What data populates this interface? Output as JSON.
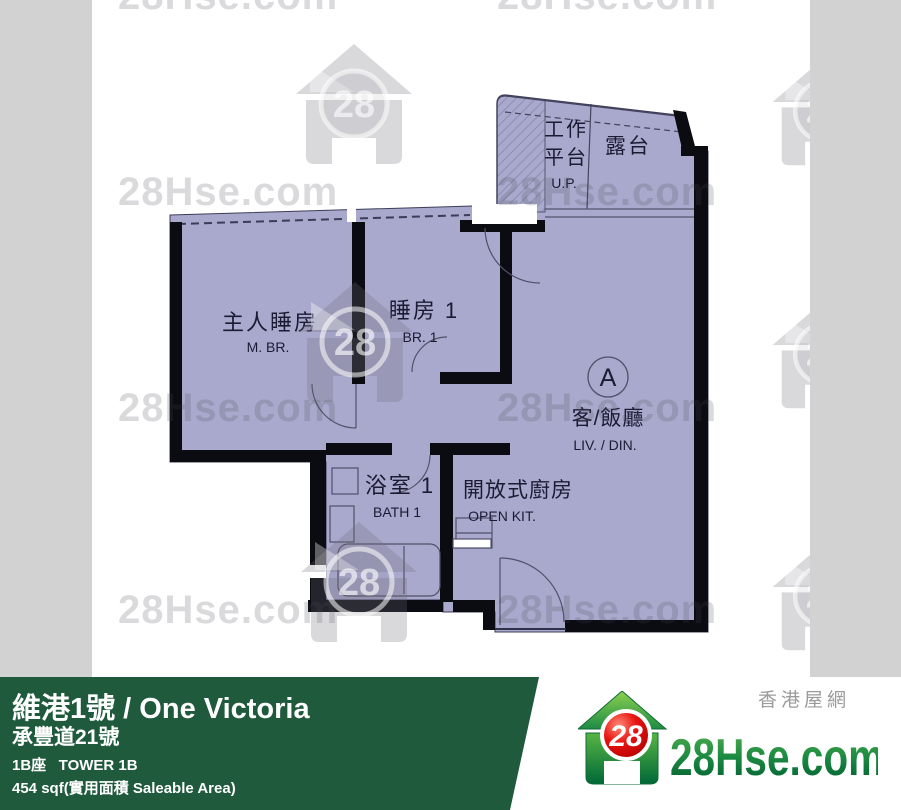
{
  "watermark": {
    "text": "28Hse.com",
    "logo_number": "28"
  },
  "floorplan": {
    "unit_label": "A",
    "rooms": {
      "master_bedroom": {
        "zh": "主人睡房",
        "en": "M. BR."
      },
      "bedroom_1": {
        "zh": "睡房 1",
        "en": "BR. 1"
      },
      "bathroom_1": {
        "zh": "浴室 1",
        "en": "BATH 1"
      },
      "open_kitchen": {
        "zh": "開放式廚房",
        "en": "OPEN KIT."
      },
      "living_dining": {
        "zh": "客/飯廳",
        "en": "LIV. / DIN."
      },
      "utility_platform": {
        "zh_line_1": "工作",
        "zh_line_2": "平台",
        "en": "U.P."
      },
      "balcony": {
        "zh": "露台"
      }
    }
  },
  "footer": {
    "title": "維港1號 / One Victoria",
    "address": "承豐道21號",
    "tower": "1B座   TOWER 1B",
    "area": "454 sqf(實用面積 Saleable Area)",
    "brand": {
      "site_zh": "香港屋網",
      "site_en": "28Hse.com",
      "logo_number": "28"
    }
  },
  "colors": {
    "plan_fill": "#a9a9cd",
    "wall_black": "#0b0b12",
    "strip_gray": "#d2d2d2",
    "bar_green": "#1f5a3d",
    "logo_green_dark": "#006838",
    "logo_green_light": "#6abf4b",
    "logo_red": "#e8140e"
  }
}
